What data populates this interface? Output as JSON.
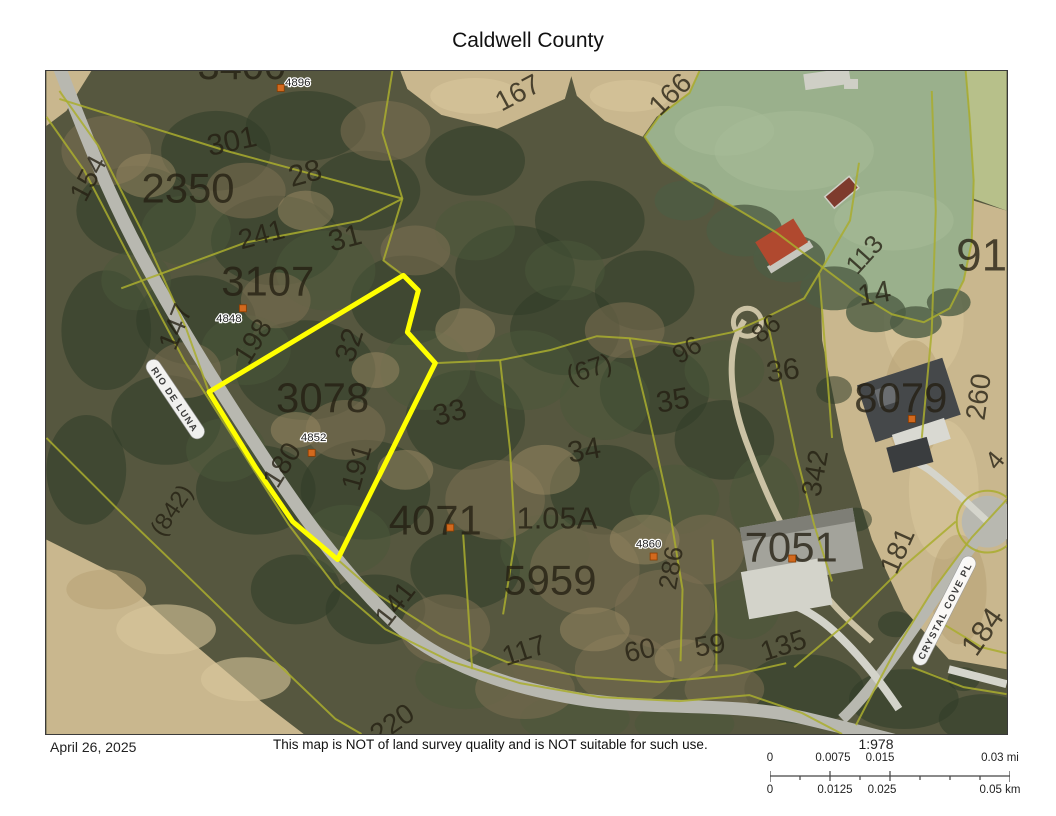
{
  "title": "Caldwell County",
  "footer": {
    "date": "April 26, 2025",
    "disclaimer": "This map is NOT of land survey quality and is NOT suitable for such use."
  },
  "scale_bar": {
    "ratio": "1:978",
    "mi_labels": [
      "0",
      "0.0075",
      "0.015",
      "0.03 mi"
    ],
    "km_labels": [
      "0",
      "0.0125",
      "0.025",
      "0.05 km"
    ]
  },
  "map": {
    "colors": {
      "highlight": "#FFFF00",
      "parcel_line": "#A9AD2E",
      "marker": "#D2691E",
      "water": "#9AB08C",
      "field": "#C9B78E",
      "road": "#B8B8B0"
    },
    "road_labels": [
      {
        "t": "RIO DE LUNA",
        "x": 128,
        "y": 330,
        "r": 56
      },
      {
        "t": "CRYSTAL COVE PL",
        "x": 902,
        "y": 542,
        "r": -63
      }
    ],
    "parcel_labels": [
      {
        "t": "3400",
        "x": 196,
        "y": 8,
        "s": 40
      },
      {
        "t": "2350",
        "x": 142,
        "y": 132,
        "s": 42
      },
      {
        "t": "3107",
        "x": 222,
        "y": 225,
        "s": 42
      },
      {
        "t": "3078",
        "x": 277,
        "y": 342,
        "s": 42
      },
      {
        "t": "4071",
        "x": 390,
        "y": 465,
        "s": 42
      },
      {
        "t": "5959",
        "x": 505,
        "y": 525,
        "s": 42
      },
      {
        "t": "1.05A",
        "x": 512,
        "y": 459,
        "s": 31
      },
      {
        "t": "8079",
        "x": 857,
        "y": 342,
        "s": 42
      },
      {
        "t": "7051",
        "x": 747,
        "y": 492,
        "s": 42
      },
      {
        "t": "91",
        "x": 938,
        "y": 200,
        "s": 46
      }
    ],
    "lot_labels": [
      {
        "t": "301",
        "x": 188,
        "y": 80,
        "r": -12,
        "s": 30
      },
      {
        "t": "28",
        "x": 262,
        "y": 112,
        "r": -15,
        "s": 30
      },
      {
        "t": "31",
        "x": 302,
        "y": 177,
        "r": -15,
        "s": 30
      },
      {
        "t": "241",
        "x": 218,
        "y": 173,
        "r": -15,
        "s": 28
      },
      {
        "t": "154",
        "x": 50,
        "y": 112,
        "r": -62,
        "s": 28
      },
      {
        "t": "147",
        "x": 138,
        "y": 260,
        "r": -68,
        "s": 28
      },
      {
        "t": "198",
        "x": 215,
        "y": 276,
        "r": -58,
        "s": 28
      },
      {
        "t": "32",
        "x": 313,
        "y": 278,
        "r": -72,
        "s": 30
      },
      {
        "t": "180",
        "x": 244,
        "y": 400,
        "r": -58,
        "s": 28
      },
      {
        "t": "191",
        "x": 320,
        "y": 400,
        "r": -74,
        "s": 28
      },
      {
        "t": "33",
        "x": 407,
        "y": 352,
        "r": -15,
        "s": 30
      },
      {
        "t": "34",
        "x": 541,
        "y": 390,
        "r": -10,
        "s": 30
      },
      {
        "t": "35",
        "x": 630,
        "y": 340,
        "r": -10,
        "s": 30
      },
      {
        "t": "36",
        "x": 740,
        "y": 310,
        "r": -8,
        "s": 30
      },
      {
        "t": "(67)",
        "x": 547,
        "y": 307,
        "r": -18,
        "s": 26
      },
      {
        "t": "96",
        "x": 647,
        "y": 287,
        "r": -32,
        "s": 26
      },
      {
        "t": "86",
        "x": 727,
        "y": 265,
        "r": -38,
        "s": 26
      },
      {
        "t": "113",
        "x": 827,
        "y": 190,
        "r": -48,
        "s": 26
      },
      {
        "t": "14",
        "x": 832,
        "y": 233,
        "r": -10,
        "s": 30
      },
      {
        "t": "260",
        "x": 944,
        "y": 328,
        "r": -82,
        "s": 28
      },
      {
        "t": "342",
        "x": 780,
        "y": 405,
        "r": -80,
        "s": 28
      },
      {
        "t": "181",
        "x": 862,
        "y": 485,
        "r": -66,
        "s": 28
      },
      {
        "t": "184",
        "x": 947,
        "y": 568,
        "r": -55,
        "s": 30
      },
      {
        "t": "135",
        "x": 742,
        "y": 585,
        "r": -18,
        "s": 28
      },
      {
        "t": "59",
        "x": 667,
        "y": 585,
        "r": -10,
        "s": 28
      },
      {
        "t": "60",
        "x": 597,
        "y": 590,
        "r": -12,
        "s": 28
      },
      {
        "t": "117",
        "x": 482,
        "y": 590,
        "r": -18,
        "s": 28
      },
      {
        "t": "141",
        "x": 357,
        "y": 540,
        "r": -52,
        "s": 28
      },
      {
        "t": "286",
        "x": 635,
        "y": 500,
        "r": -80,
        "s": 26
      },
      {
        "t": "(842)",
        "x": 132,
        "y": 445,
        "r": -56,
        "s": 24
      },
      {
        "t": "166",
        "x": 632,
        "y": 30,
        "r": -44,
        "s": 28
      },
      {
        "t": "167",
        "x": 477,
        "y": 30,
        "r": -28,
        "s": 28
      },
      {
        "t": "220",
        "x": 352,
        "y": 662,
        "r": -35,
        "s": 28
      },
      {
        "t": "4",
        "x": 958,
        "y": 396,
        "r": -50,
        "s": 26
      }
    ],
    "address_labels": [
      {
        "t": "4896",
        "x": 252,
        "y": 15
      },
      {
        "t": "4848",
        "x": 183,
        "y": 252
      },
      {
        "t": "4852",
        "x": 268,
        "y": 371
      },
      {
        "t": "4860",
        "x": 604,
        "y": 478
      }
    ],
    "markers": [
      {
        "x": 235,
        "y": 17
      },
      {
        "x": 197,
        "y": 238
      },
      {
        "x": 266,
        "y": 383
      },
      {
        "x": 609,
        "y": 487
      },
      {
        "x": 868,
        "y": 349
      },
      {
        "x": 748,
        "y": 489
      },
      {
        "x": 405,
        "y": 458
      }
    ]
  }
}
